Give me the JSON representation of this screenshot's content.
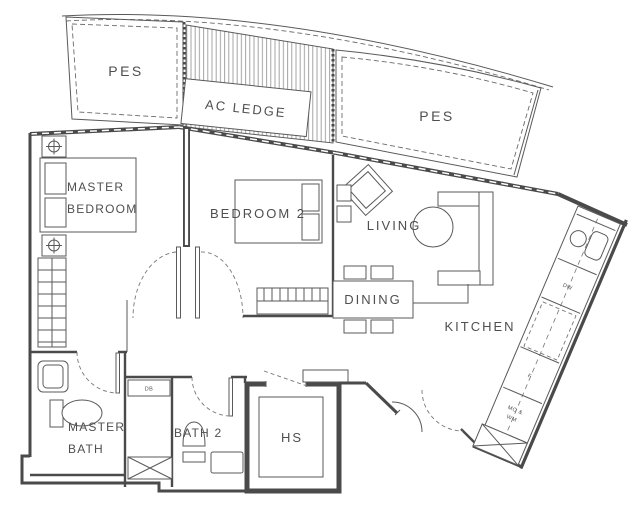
{
  "floor_plan": {
    "rooms": {
      "pes_left": "PES",
      "ac_ledge": "AC LEDGE",
      "pes_right": "PES",
      "master_bedroom_line1": "MASTER",
      "master_bedroom_line2": "BEDROOM",
      "bedroom_2": "BEDROOM 2",
      "living": "LIVING",
      "dining": "DINING",
      "kitchen": "KITCHEN",
      "master_bath_line1": "MASTER",
      "master_bath_line2": "BATH",
      "bath_2": "BATH 2",
      "household_shelter": "HS"
    },
    "fixtures": {
      "distribution_board": "DB",
      "dishwasher": "DW",
      "fridge": "F",
      "micro_washer_line1": "MO &",
      "micro_washer_line2": "WM"
    },
    "colors": {
      "wall_line": "#4a4a4a",
      "text": "#4f4f4f",
      "hatch": "#9a9a9a",
      "background": "#ffffff"
    }
  }
}
